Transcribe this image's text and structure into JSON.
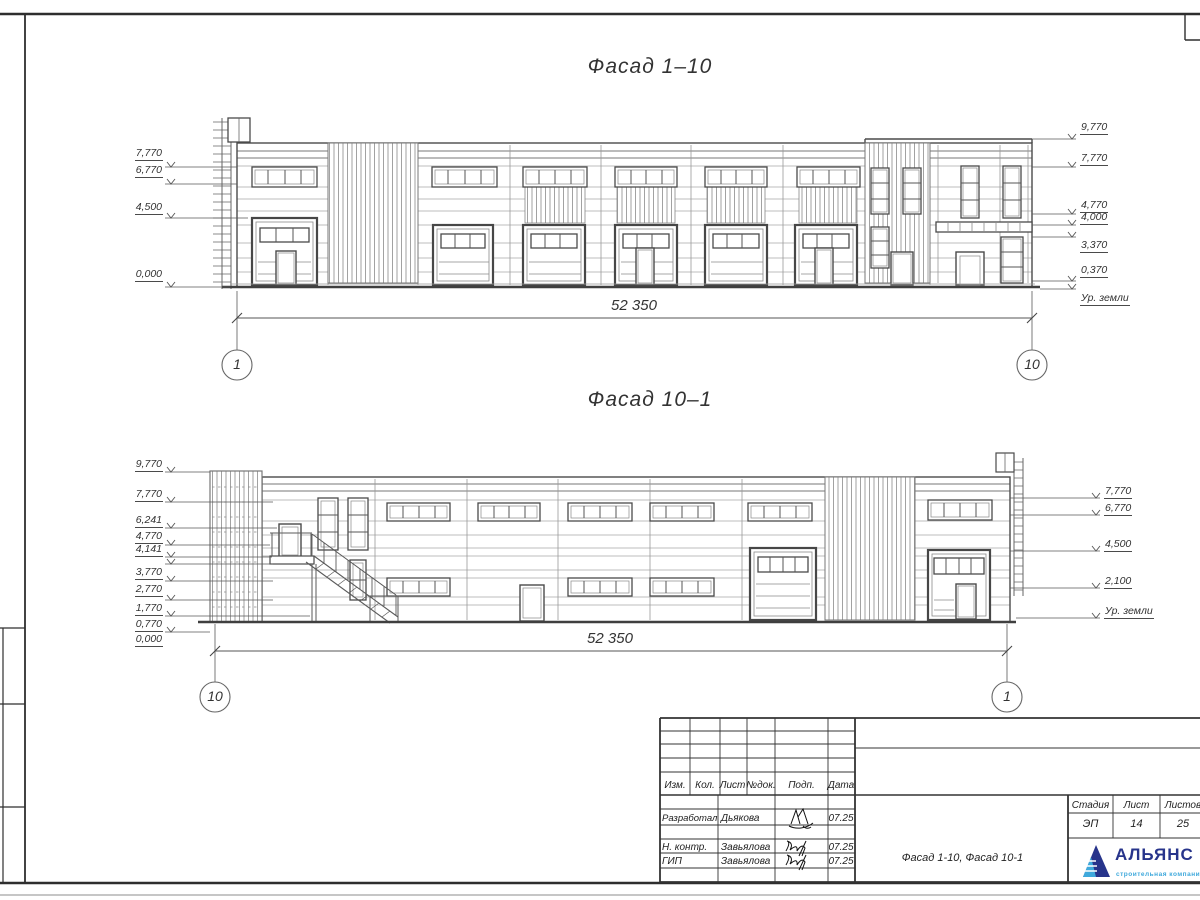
{
  "facades": [
    {
      "title": "Фасад 1–10",
      "dimension": "52 350",
      "axis_left": "1",
      "axis_right": "10",
      "ground_label": "Ур. земли",
      "marks_left": [
        "7,770",
        "6,770",
        "4,500",
        "0,000"
      ],
      "marks_right": [
        "9,770",
        "7,770",
        "4,770",
        "4,000",
        "3,370",
        "0,370"
      ]
    },
    {
      "title": "Фасад 10–1",
      "dimension": "52 350",
      "axis_left": "10",
      "axis_right": "1",
      "ground_label": "Ур. земли",
      "marks_left": [
        "9,770",
        "7,770",
        "6,241",
        "4,770",
        "4,141",
        "3,770",
        "2,770",
        "1,770",
        "0,770",
        "0,000"
      ],
      "marks_right": [
        "7,770",
        "6,770",
        "4,500",
        "2,100"
      ]
    }
  ],
  "stamp": {
    "change_headers": [
      "Изм.",
      "Кол.",
      "Лист",
      "№док.",
      "Подп.",
      "Дата"
    ],
    "rows": [
      {
        "role": "Разработал",
        "name": "Дьякова",
        "date": "07.25"
      },
      {
        "role": "Н. контр.",
        "name": "Завьялова",
        "date": "07.25"
      },
      {
        "role": "ГИП",
        "name": "Завьялова",
        "date": "07.25"
      }
    ],
    "doc_title": "Фасад 1-10, Фасад 10-1",
    "stage_label": "Стадия",
    "stage_value": "ЭП",
    "sheet_label": "Лист",
    "sheet_value": "14",
    "sheets_label": "Листов",
    "sheets_value": "25",
    "logo": {
      "name": "АЛЬЯНС",
      "tagline": "строительная компания",
      "color_primary": "#27348b",
      "color_secondary": "#3fa9dc"
    }
  }
}
